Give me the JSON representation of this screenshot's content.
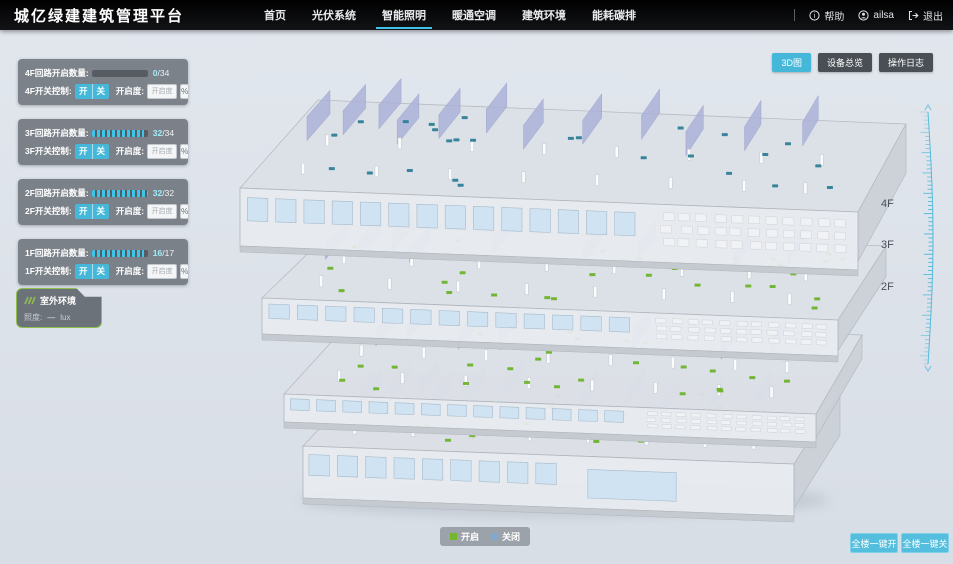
{
  "app": {
    "title": "城亿绿建建筑管理平台"
  },
  "nav": {
    "items": [
      {
        "label": "首页",
        "active": false
      },
      {
        "label": "光伏系统",
        "active": false
      },
      {
        "label": "智能照明",
        "active": true
      },
      {
        "label": "暖通空调",
        "active": false
      },
      {
        "label": "建筑环境",
        "active": false
      },
      {
        "label": "能耗碳排",
        "active": false
      }
    ]
  },
  "user_menu": {
    "help": "帮助",
    "username": "ailsa",
    "logout": "退出"
  },
  "view_buttons": [
    {
      "label": "3D图",
      "active": true
    },
    {
      "label": "设备总览",
      "active": false
    },
    {
      "label": "操作日志",
      "active": false
    }
  ],
  "floor_panels": [
    {
      "floor": "4F",
      "count_label": "4F回路开启数量:",
      "value": "0",
      "total": "/34",
      "pct": 0,
      "switch_label": "4F开关控制:",
      "on_label": "开",
      "off_label": "关",
      "dim_label": "开启度:",
      "dim_placeholder": "开启度",
      "pct_label": "%"
    },
    {
      "floor": "3F",
      "count_label": "3F回路开启数量:",
      "value": "32",
      "total": "/34",
      "pct": 94,
      "switch_label": "3F开关控制:",
      "on_label": "开",
      "off_label": "关",
      "dim_label": "开启度:",
      "dim_placeholder": "开启度",
      "pct_label": "%"
    },
    {
      "floor": "2F",
      "count_label": "2F回路开启数量:",
      "value": "32",
      "total": "/32",
      "pct": 100,
      "switch_label": "2F开关控制:",
      "on_label": "开",
      "off_label": "关",
      "dim_label": "开启度:",
      "dim_placeholder": "开启度",
      "pct_label": "%"
    },
    {
      "floor": "1F",
      "count_label": "1F回路开启数量:",
      "value": "16",
      "total": "/17",
      "pct": 94,
      "switch_label": "1F开关控制:",
      "on_label": "开",
      "off_label": "关",
      "dim_label": "开启度:",
      "dim_placeholder": "开启度",
      "pct_label": "%"
    }
  ],
  "outdoor_panel": {
    "title": "室外环境",
    "metric_label": "照度:",
    "metric_value": "—",
    "metric_unit": "lux"
  },
  "floor_labels": [
    {
      "label": "4F"
    },
    {
      "label": "3F"
    },
    {
      "label": "2F"
    },
    {
      "label": "1F"
    }
  ],
  "legend": {
    "on_label": "开启",
    "off_label": "关闭",
    "on_color": "#74b62e",
    "off_color": "#7fa8d2"
  },
  "global_buttons": [
    {
      "label": "全楼一键开"
    },
    {
      "label": "全楼一键关"
    }
  ],
  "colors": {
    "accent": "#45b8d9",
    "nav_bg": "#0b0c0e",
    "page_bg": "#dde3ea",
    "panel_bg": "#6a7078",
    "on_dot": "#6db32b",
    "off_dot": "#2e7f97",
    "ruler": "#41b3d8"
  }
}
